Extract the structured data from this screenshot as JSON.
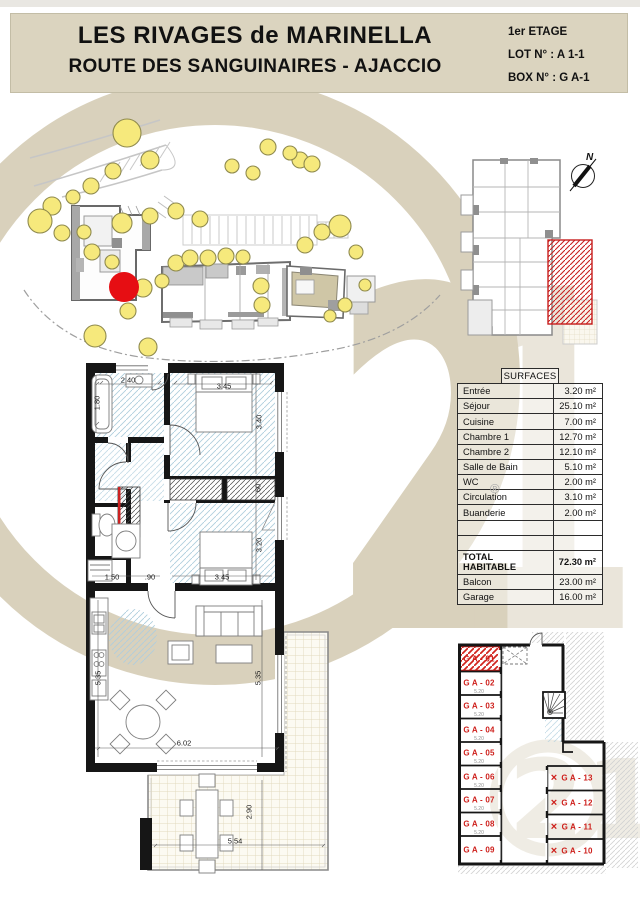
{
  "header": {
    "title_line1": "LES RIVAGES de MARINELLA",
    "title_line2": "ROUTE DES SANGUINAIRES - AJACCIO",
    "floor": "1er ETAGE",
    "lot": "LOT N° : A 1-1",
    "box": "BOX N° : G A-1"
  },
  "key_plan": {
    "north_label": "N"
  },
  "surfaces": {
    "title": "SURFACES",
    "rows": [
      {
        "label": "Entrée",
        "value": "3.20 m²"
      },
      {
        "label": "Séjour",
        "value": "25.10 m²"
      },
      {
        "label": "Cuisine",
        "value": "7.00 m²"
      },
      {
        "label": "Chambre 1",
        "value": "12.70 m²"
      },
      {
        "label": "Chambre 2",
        "value": "12.10 m²"
      },
      {
        "label": "Salle de Bain",
        "value": "5.10 m²"
      },
      {
        "label": "WC",
        "value": "2.00 m²"
      },
      {
        "label": "Circulation",
        "value": "3.10 m²"
      },
      {
        "label": "Buanderie",
        "value": "2.00 m²"
      },
      {
        "label": "",
        "value": ""
      },
      {
        "label": "",
        "value": ""
      },
      {
        "label": "TOTAL HABITABLE",
        "value": "72.30 m²",
        "bold": true
      },
      {
        "label": "Balcon",
        "value": "23.00 m²"
      },
      {
        "label": "Garage",
        "value": "16.00 m²"
      }
    ]
  },
  "floor_plan": {
    "dims": [
      {
        "text": "2.40",
        "x": 128,
        "y": 380
      },
      {
        "text": "1.80",
        "x": 97,
        "y": 403,
        "rot": -90
      },
      {
        "text": "3.45",
        "x": 224,
        "y": 386
      },
      {
        "text": "3.40",
        "x": 259,
        "y": 422,
        "rot": -90
      },
      {
        "text": ".60",
        "x": 258,
        "y": 489,
        "rot": -90
      },
      {
        "text": "3.20",
        "x": 259,
        "y": 545,
        "rot": -90
      },
      {
        "text": "3.45",
        "x": 222,
        "y": 577
      },
      {
        "text": "1.50",
        "x": 112,
        "y": 577
      },
      {
        "text": ".90",
        "x": 150,
        "y": 577
      },
      {
        "text": "5.35",
        "x": 98,
        "y": 678,
        "rot": -90
      },
      {
        "text": "5.35",
        "x": 258,
        "y": 678,
        "rot": -90
      },
      {
        "text": "6.02",
        "x": 184,
        "y": 743
      },
      {
        "text": "2.90",
        "x": 249,
        "y": 812,
        "rot": -90
      },
      {
        "text": "5.54",
        "x": 235,
        "y": 841
      }
    ]
  },
  "parking": {
    "left_garages": [
      {
        "label": "G A - 01",
        "x": 479,
        "y": 659,
        "dim": ""
      },
      {
        "label": "G A - 02",
        "x": 479,
        "y": 683,
        "dim": "5.20"
      },
      {
        "label": "G A - 03",
        "x": 479,
        "y": 706,
        "dim": "5.20"
      },
      {
        "label": "G A - 04",
        "x": 479,
        "y": 730,
        "dim": "5.20"
      },
      {
        "label": "G A - 05",
        "x": 479,
        "y": 753,
        "dim": "5.20"
      },
      {
        "label": "G A - 06",
        "x": 479,
        "y": 777,
        "dim": "5.20"
      },
      {
        "label": "G A - 07",
        "x": 479,
        "y": 800,
        "dim": "5.20"
      },
      {
        "label": "G A - 08",
        "x": 479,
        "y": 824,
        "dim": "5.20"
      },
      {
        "label": "G A - 09",
        "x": 479,
        "y": 850,
        "dim": ""
      }
    ],
    "right_garages": [
      {
        "label": "G A - 13",
        "x": 577,
        "y": 778,
        "cross": true
      },
      {
        "label": "G A - 12",
        "x": 577,
        "y": 803,
        "cross": true
      },
      {
        "label": "G A - 11",
        "x": 577,
        "y": 827,
        "cross": true
      },
      {
        "label": "G A - 10",
        "x": 577,
        "y": 851,
        "cross": true
      }
    ]
  },
  "watermark": {
    "big_text": "21",
    "small_text": "21",
    "registered": "®"
  },
  "colors": {
    "header_beige": "#DBD4BF",
    "watermark_beige": "#D9D1BC",
    "highlight_red": "#CE1F1B",
    "location_red": "#E60E13",
    "tree_yellow": "#F6E97C",
    "wall_black": "#161616",
    "hatch_blue": "#AFCEDE"
  }
}
